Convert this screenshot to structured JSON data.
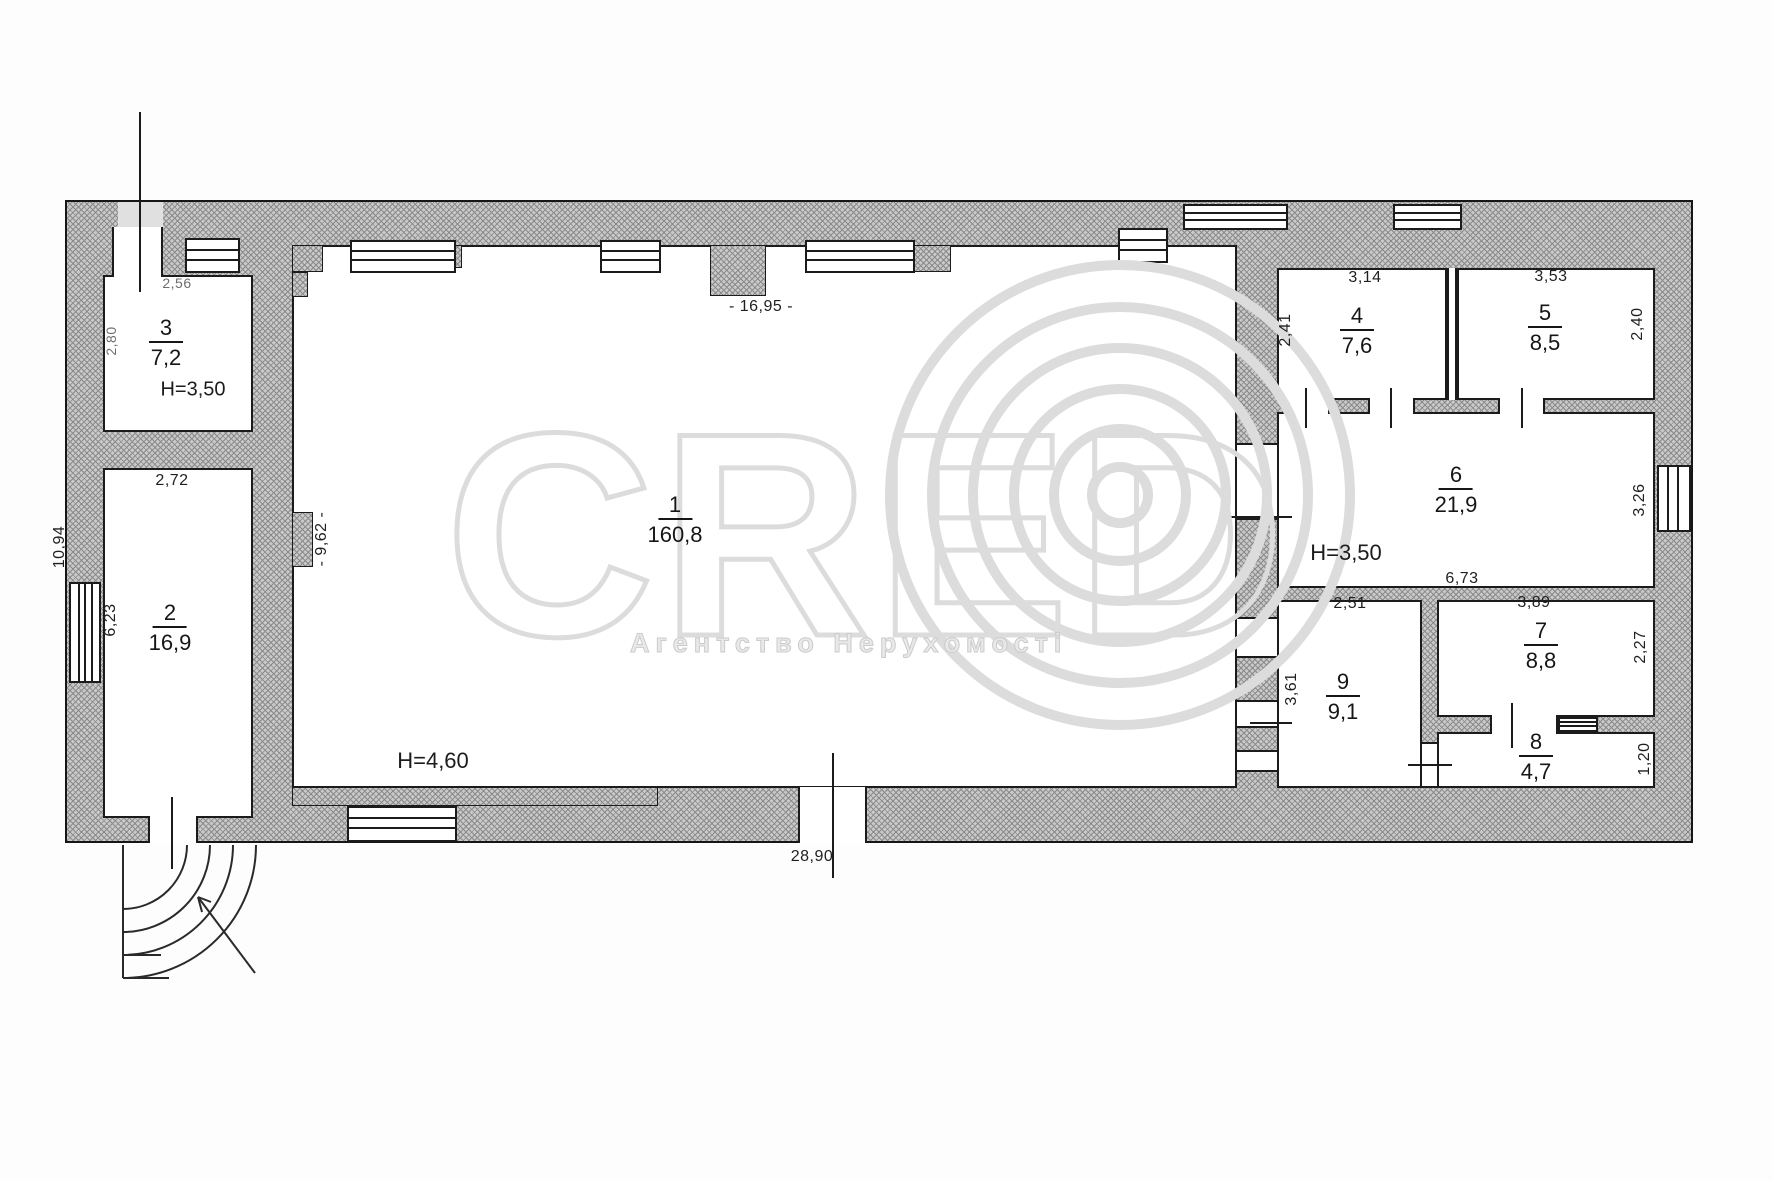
{
  "watermark": {
    "brand": "CRED",
    "subtitle": "Агентство Нерухомості"
  },
  "plan": {
    "rooms": {
      "r1": {
        "number": "1",
        "area": "160,8"
      },
      "r2": {
        "number": "2",
        "area": "16,9"
      },
      "r3": {
        "number": "3",
        "area": "7,2"
      },
      "r4": {
        "number": "4",
        "area": "7,6"
      },
      "r5": {
        "number": "5",
        "area": "8,5"
      },
      "r6": {
        "number": "6",
        "area": "21,9"
      },
      "r7": {
        "number": "7",
        "area": "8,8"
      },
      "r8": {
        "number": "8",
        "area": "4,7"
      },
      "r9": {
        "number": "9",
        "area": "9,1"
      }
    },
    "heights": {
      "hall": "H=4,60",
      "r3": "H=3,50",
      "r6": "H=3,50"
    },
    "dims": {
      "top": "- 16,95 -",
      "bottom": "28,90",
      "left_outer": "10,94",
      "r3_width": "2,56",
      "r3_depth": "2,80",
      "r2_width": "2,72",
      "r2_window": "6,23",
      "hall_left": "- 9,62 -",
      "r4_width": "3,14",
      "r4_depth": "2,41",
      "r5_width": "3,53",
      "r5_depth": "2,40",
      "r6_width": "6,73",
      "r6_window": "3,26",
      "r9_width": "2,51",
      "r9_depth": "3,61",
      "r7_width": "3,89",
      "r7_depth": "2,27",
      "r8_depth": "1,20"
    }
  }
}
